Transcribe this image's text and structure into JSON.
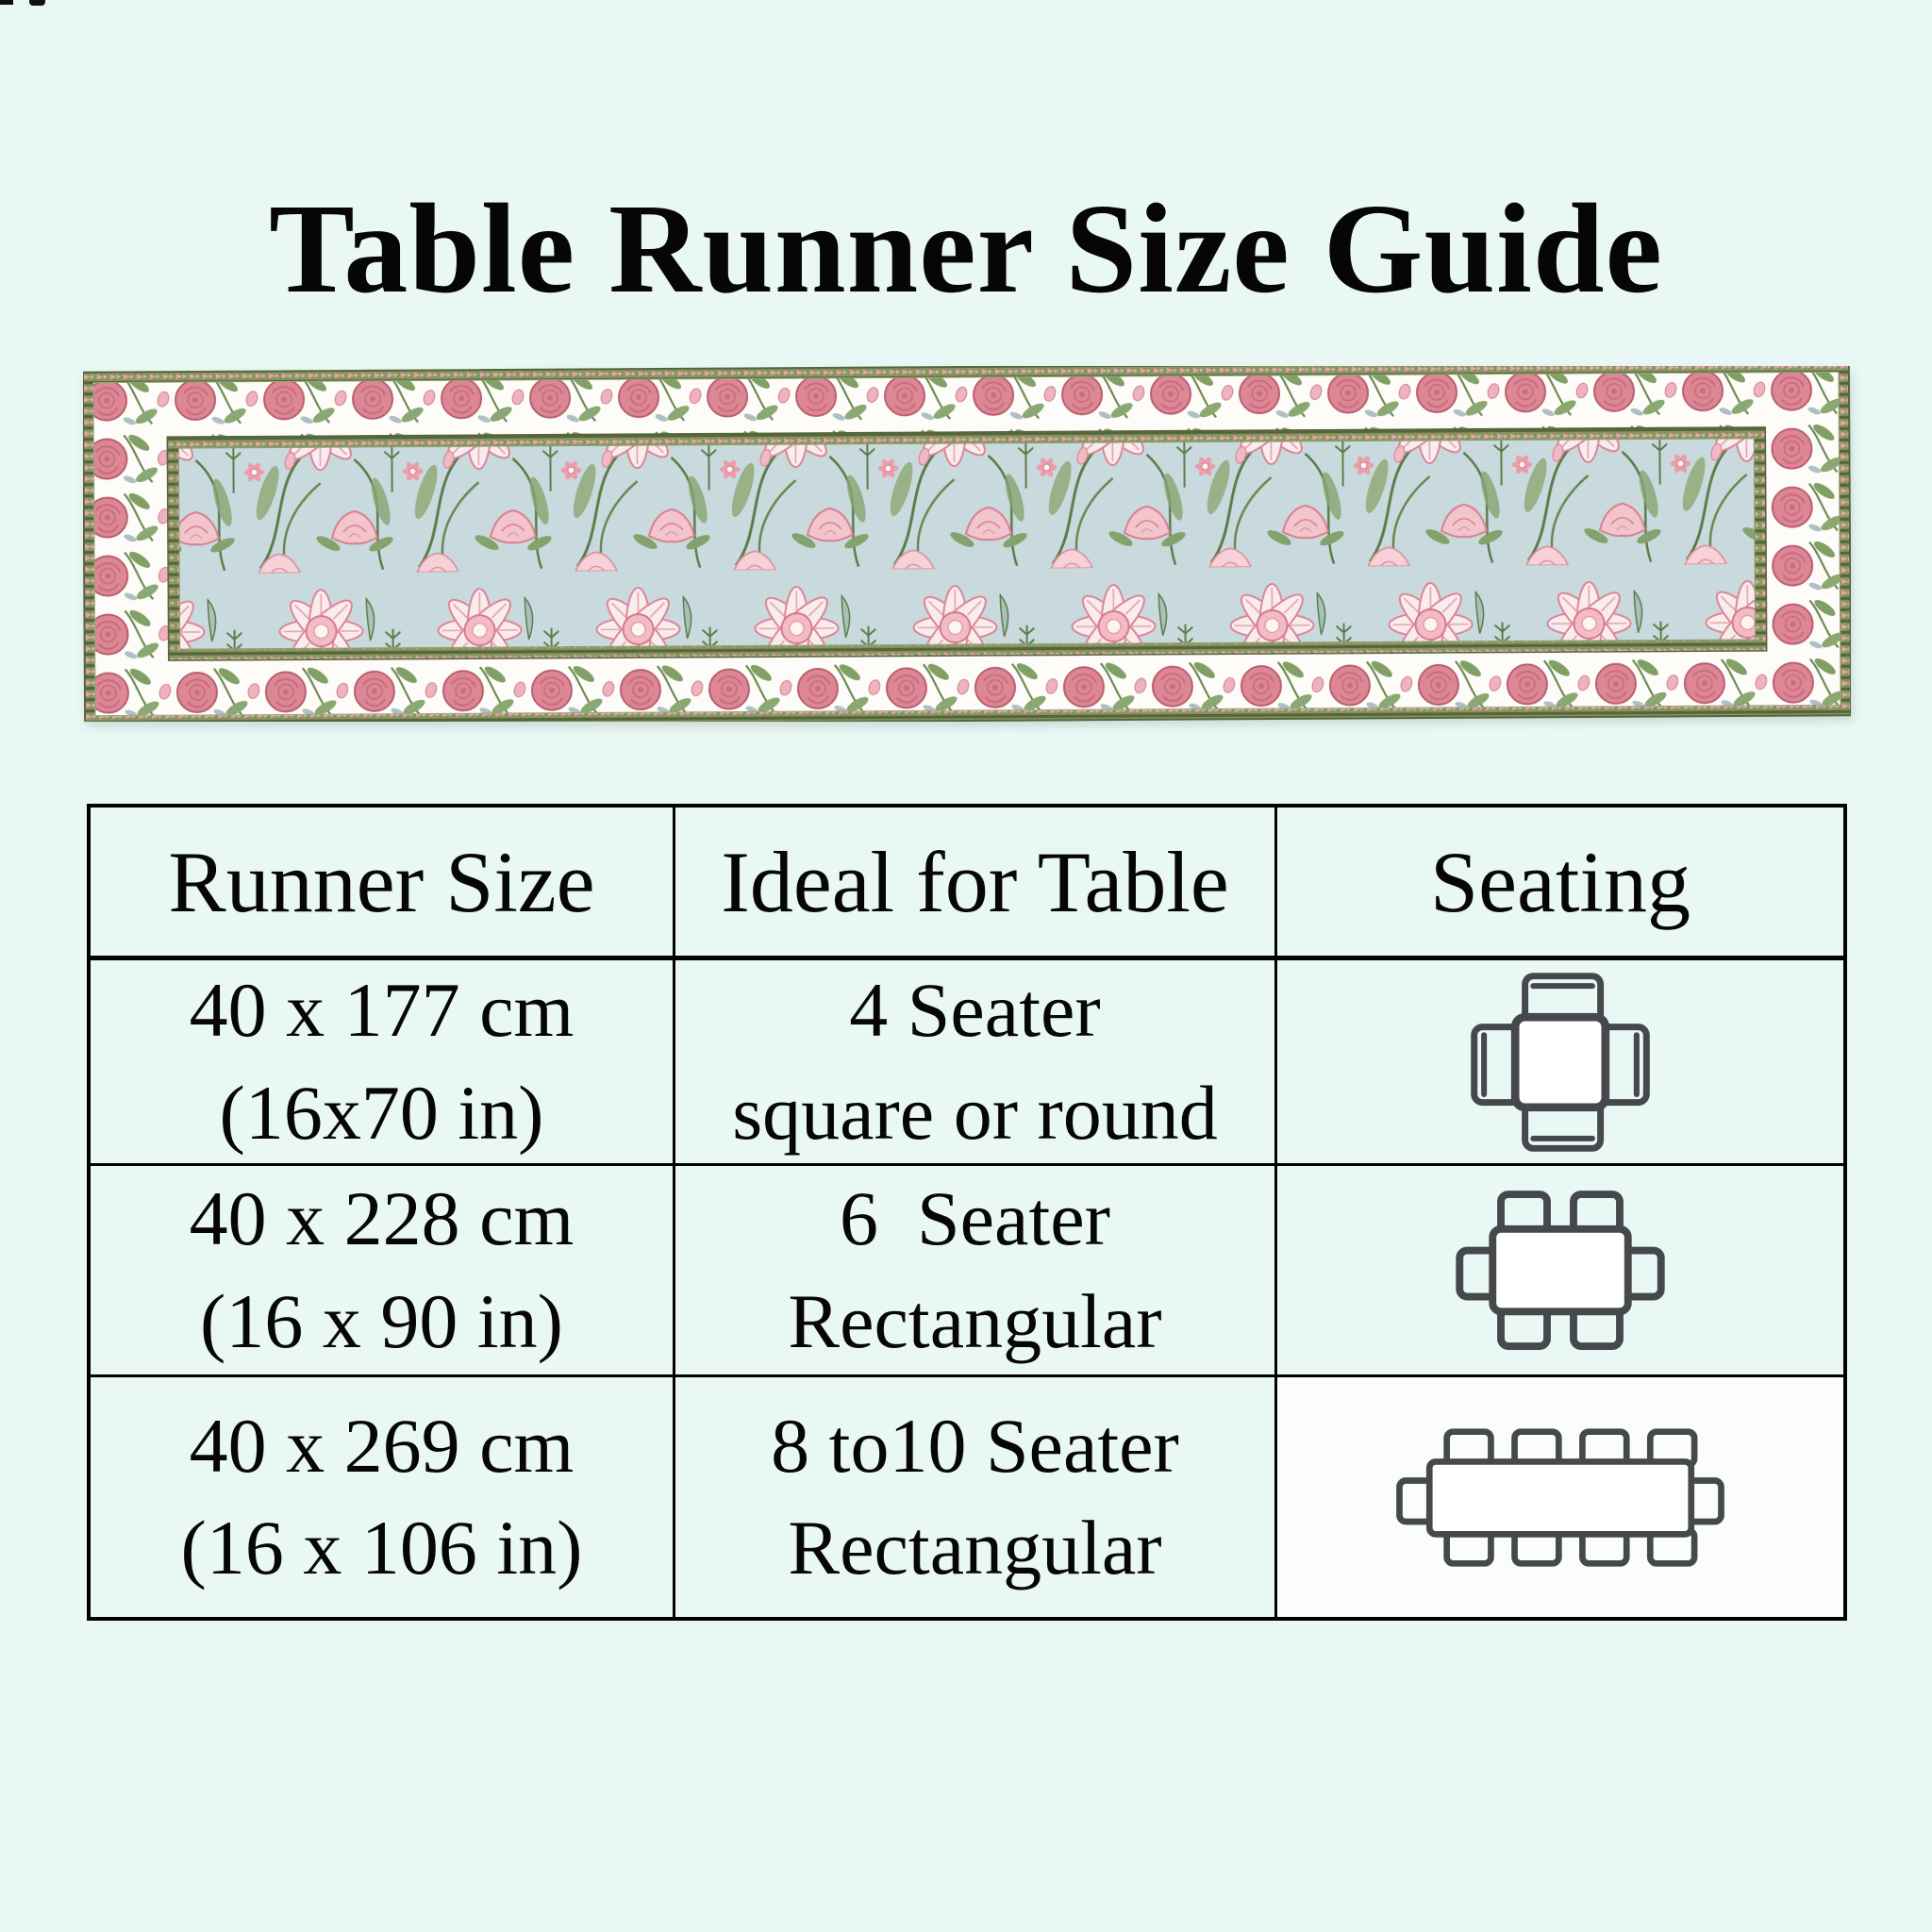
{
  "page": {
    "title": "Table Runner Size Guide"
  },
  "runner": {
    "description": "floral block-print table runner, pink flowers and green vines on pale blue ground with white rose border"
  },
  "size_table": {
    "headers": [
      "Runner Size",
      "Ideal for Table",
      "Seating"
    ],
    "rows": [
      {
        "size_cm": "40 x 177 cm",
        "size_in": "(16x70 in)",
        "ideal_line1": "4 Seater",
        "ideal_line2": "square or round",
        "icon": "square-table-4-chairs-top-view"
      },
      {
        "size_cm": "40 x 228 cm",
        "size_in": "(16 x 90 in)",
        "ideal_line1": "6  Seater",
        "ideal_line2": "Rectangular",
        "icon": "rectangular-table-6-chairs-top-view"
      },
      {
        "size_cm": "40 x 269 cm",
        "size_in": "(16 x 106 in)",
        "ideal_line1": "8 to10 Seater",
        "ideal_line2": "Rectangular",
        "icon": "rectangular-table-10-chairs-top-view"
      }
    ]
  },
  "colors": {
    "background": "#eaf8f5",
    "text": "#060606",
    "table_border": "#000000",
    "icon_stroke": "#45494b",
    "runner_field": "#c9dade",
    "runner_rose": "#dd8694",
    "runner_leaf": "#7f9d65",
    "runner_chain_band": "#8a9660",
    "runner_band_white": "#fdfcf8"
  }
}
